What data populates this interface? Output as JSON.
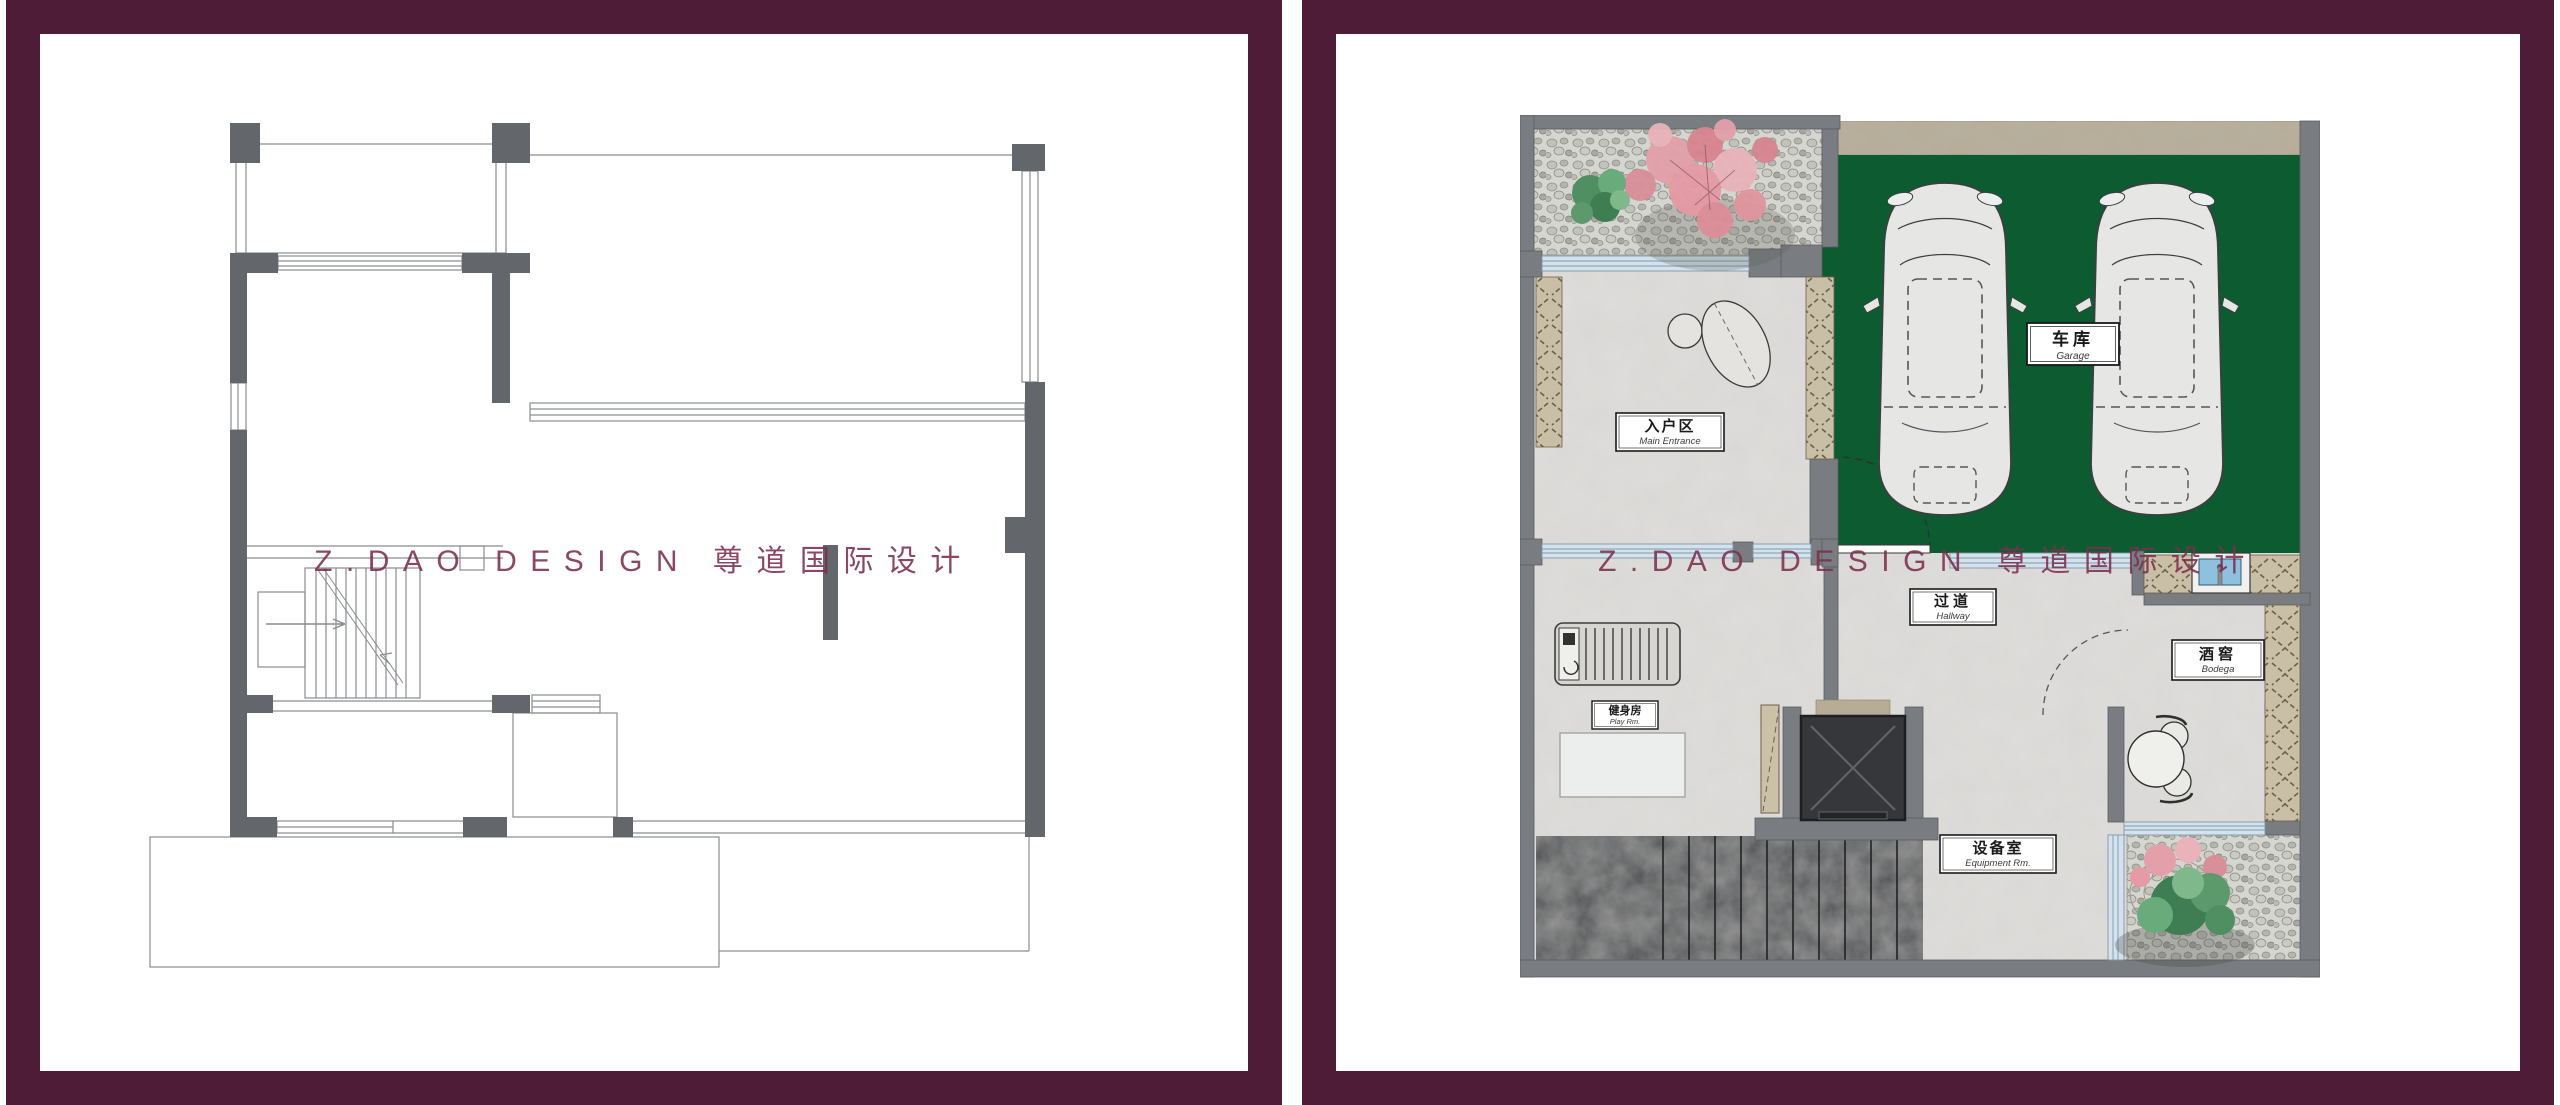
{
  "watermark": "Z.DAO DESIGN 尊道国际设计",
  "rooms": {
    "garage": {
      "zh": "车库",
      "en": "Garage"
    },
    "main_entrance": {
      "zh": "入户区",
      "en": "Main Entrance"
    },
    "hallway": {
      "zh": "过道",
      "en": "Hallway"
    },
    "bodega": {
      "zh": "酒窖",
      "en": "Bodega"
    },
    "equipment_room": {
      "zh": "设备室",
      "en": "Equipment Rm."
    },
    "gym": {
      "zh": "健身房",
      "en": "Play Rm."
    }
  },
  "colors": {
    "frame": "#4e1c37",
    "watermark": "#7c2f4f",
    "garage_floor": "#0d5b31",
    "wall_gray": "#797c80",
    "wall_dark": "#63666a",
    "window_glass": "#d3e2ec",
    "hatch_tan": "#c9bea6",
    "marble_light": "#dedddb",
    "marble_dark": "#47484a",
    "threshold_marble": "#b5ab96",
    "sink_blue": "#8fc0dd",
    "blossom_pink": "#e29aa4",
    "shrub_green": "#4f8f62",
    "car_body": "#e6e7e5"
  }
}
